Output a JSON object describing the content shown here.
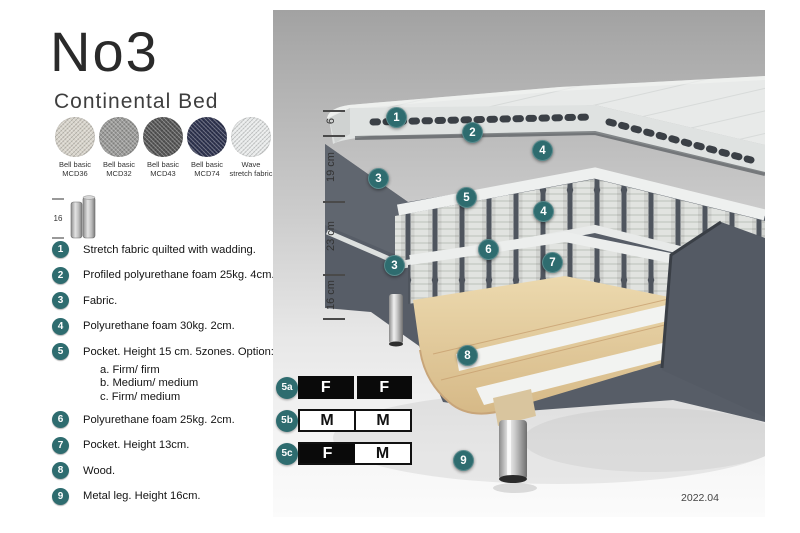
{
  "header": {
    "title": "No3",
    "subtitle": "Continental Bed"
  },
  "swatches": [
    {
      "line1": "Bell basic",
      "line2": "MCD36",
      "color": "#d9d5cc"
    },
    {
      "line1": "Bell basic",
      "line2": "MCD32",
      "color": "#9b9b99"
    },
    {
      "line1": "Bell basic",
      "line2": "MCD43",
      "color": "#575757"
    },
    {
      "line1": "Bell basic",
      "line2": "MCD74",
      "color": "#2f3450"
    },
    {
      "line1": "Wave",
      "line2": "stretch fabric",
      "color": "#e9ebeb"
    }
  ],
  "leg_icon": {
    "label": "16"
  },
  "legend": {
    "items": [
      {
        "num": "1",
        "text": "Stretch fabric quilted with wadding."
      },
      {
        "num": "2",
        "text": "Profiled polyurethane foam 25kg. 4cm."
      },
      {
        "num": "3",
        "text": "Fabric."
      },
      {
        "num": "4",
        "text": "Polyurethane foam 30kg. 2cm."
      },
      {
        "num": "5",
        "text": "Pocket. Height 15 cm. 5zones. Option:",
        "options": [
          "a. Firm/ firm",
          "b. Medium/ medium",
          "c. Firm/ medium"
        ]
      },
      {
        "num": "6",
        "text": "Polyurethane foam 25kg. 2cm."
      },
      {
        "num": "7",
        "text": "Pocket. Height 13cm."
      },
      {
        "num": "8",
        "text": "Wood."
      },
      {
        "num": "9",
        "text": "Metal leg. Height 16cm."
      }
    ]
  },
  "diagram": {
    "scale": [
      "6",
      "19 cm",
      "23 cm",
      "16 cm"
    ],
    "callouts": {
      "c1": "1",
      "c2": "2",
      "c3": "3",
      "c4": "4",
      "c5": "5",
      "c6": "6",
      "c7": "7",
      "c8": "8",
      "c9": "9"
    }
  },
  "firmness": {
    "rows": [
      {
        "label": "5a",
        "cells": [
          {
            "text": "F",
            "style": "dark"
          },
          {
            "text": "F",
            "style": "dark"
          }
        ]
      },
      {
        "label": "5b",
        "cells": [
          {
            "text": "M",
            "style": "light"
          },
          {
            "text": "M",
            "style": "light"
          }
        ]
      },
      {
        "label": "5c",
        "cells": [
          {
            "text": "F",
            "style": "dark"
          },
          {
            "text": "M",
            "style": "light"
          }
        ]
      }
    ]
  },
  "footer": {
    "version": "2022.04"
  },
  "colors": {
    "accent_teal": "#2e6c6f",
    "fabric_dark": "#575d67",
    "mattress_light": "#e8eae9",
    "wood": "#e2cda0",
    "table_black": "#0a0a0a"
  }
}
